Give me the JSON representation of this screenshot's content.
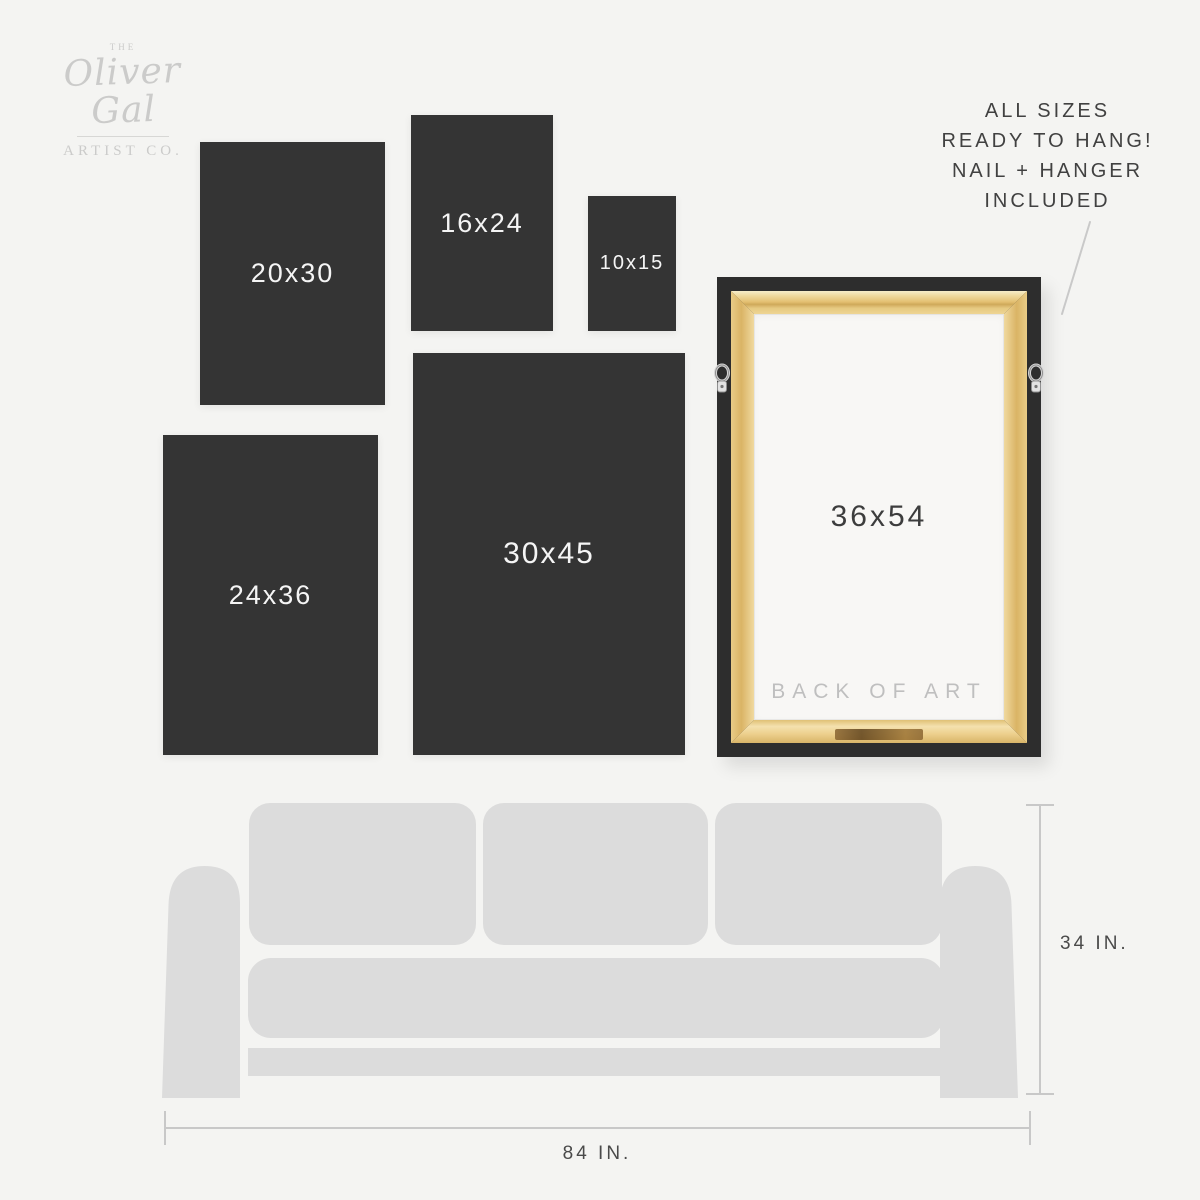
{
  "colors": {
    "background": "#f4f4f2",
    "panel": "#343434",
    "panel_text": "#f5f5f5",
    "couch": "#dcdcdc",
    "wood": "#e6c47e",
    "frame_border": "#2d2d2d",
    "canvas_back": "#f8f7f5",
    "logo_gray": "#cbcbca",
    "dim_line": "#c8c8c8",
    "dark_text": "#414141"
  },
  "logo": {
    "prefix": "THE",
    "name": "Oliver Gal",
    "suffix": "ARTIST CO."
  },
  "annotation": {
    "lines": [
      "ALL SIZES",
      "READY TO HANG!",
      "NAIL + HANGER",
      "INCLUDED"
    ]
  },
  "panels": {
    "p20x30": "20x30",
    "p16x24": "16x24",
    "p10x15": "10x15",
    "p24x36": "24x36",
    "p30x45": "30x45"
  },
  "frame": {
    "size_label": "36x54",
    "back_label": "BACK OF ART"
  },
  "dimensions": {
    "height_label": "34 IN.",
    "width_label": "84 IN."
  }
}
